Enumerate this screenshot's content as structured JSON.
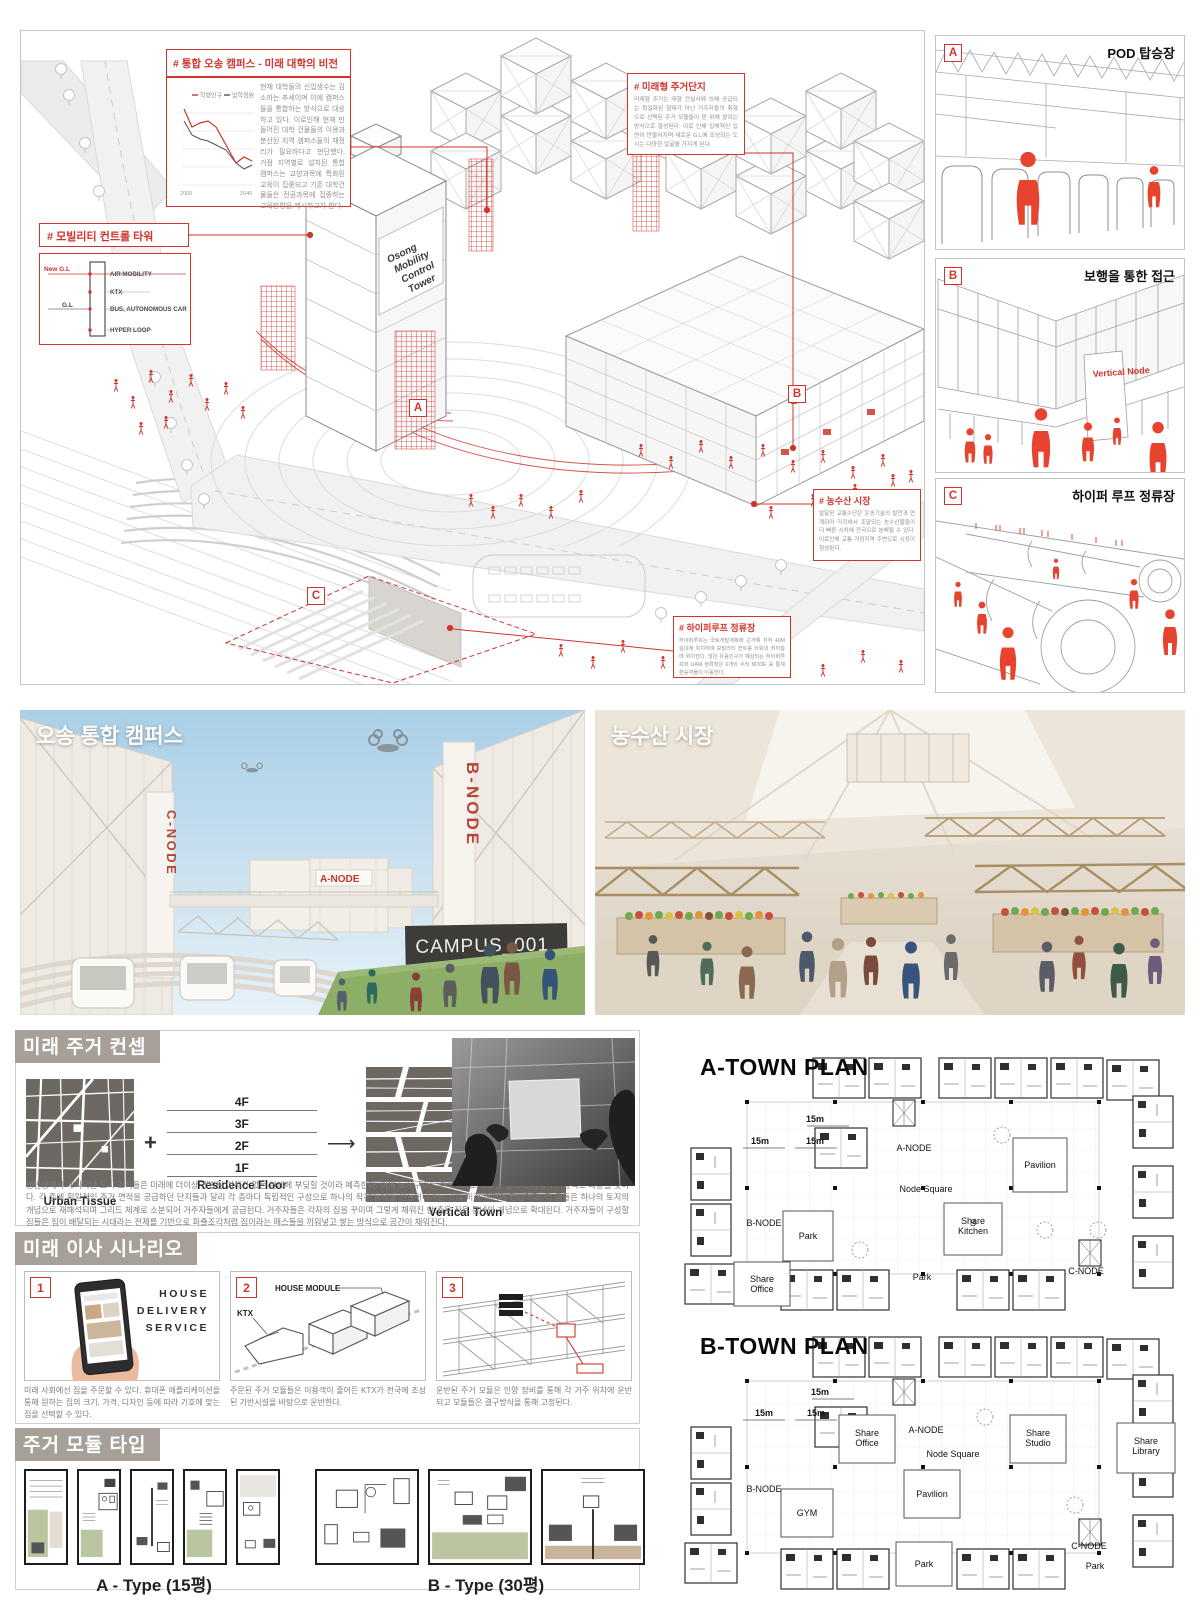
{
  "iso": {
    "tower_label_lines": [
      "Osong",
      "Mobility",
      "Control",
      "Tower"
    ],
    "markers": {
      "a": "A",
      "b": "B",
      "c": "C"
    },
    "callout_campus": {
      "title": "# 통합 오송 캠퍼스 - 미래 대학의 비전",
      "body": "현재 대학들의 신입생수는 감소하는 추세이며 이에 캠퍼스들을 통합하는 방식으로 대응하고 있다. 이로인해 현재 만들어진 대학 건물들의 이용과 분산된 지역 캠퍼스들의 재정리가 필요하다고 판단했다. 거점 지역별로 설치된 통합 캠퍼스는 교양과목에 특화된 교육이 집중되고 기존 대학건물들은 전공과목에 집중하는 교육방향을 제시하고자 한다.",
      "chart": {
        "type": "line",
        "legend": [
          "학령인구",
          "입학정원"
        ],
        "x_ticks": [
          "2000",
          "2040"
        ],
        "series": [
          {
            "name": "학령인구",
            "color": "#d0342c",
            "values": [
              88,
              70,
              74,
              76,
              66,
              48,
              40,
              44,
              41
            ]
          },
          {
            "name": "입학정원",
            "color": "#555555",
            "values": [
              76,
              62,
              58,
              56,
              52,
              47,
              40,
              36,
              39
            ]
          }
        ]
      }
    },
    "callout_mobility": {
      "title": "# 모빌리티 컨트롤 타워",
      "gl_new": "New G.L",
      "gl": "G.L",
      "levels": [
        "AIR MOBILITY",
        "KTX",
        "BUS, AUTONOMOUS CAR",
        "HYPER LOOP"
      ]
    },
    "callout_housing": {
      "title": "# 미래형 주거단지",
      "body": "미래형 주거는 대형 건설사에 의해 공급되는 획일화된 형태가 아닌 거주자들의 취향으로 선택된 주거 모듈들이 판 위에 쌓이는 방식으로 형성된다. 이로 인해 입체적인 입면이 만들어지며 새로운 G.L에 조성되는 도시는 다양한 얼굴을 가지게 된다."
    },
    "callout_market": {
      "title": "# 농수산 시장",
      "body": "발달된 교통수단은 운송기술의 발전과 연계되어 각지에서 조달되는 농수산물들이 더 빠른 시차에 전국으로 분배될 수 있다. 이로인해 교통 거점지역 주변으로 시장이 형성된다."
    },
    "callout_hyperloop": {
      "title": "# 하이퍼루프 정류장",
      "body": "하이퍼루프는 국토개발계획에 근거해 지하 40M 깊이에 위치하며 모빌리티 컨트롤 타워의 최하층에 위치한다. 많은 유동인구가 예상되는 하이퍼루프와 UAM 정류장은 6개의 수직 NODE 를 통해 환승객들이 이동한다."
    }
  },
  "panels": [
    {
      "badge": "A",
      "title": "POD 탑승장"
    },
    {
      "badge": "B",
      "title": "보행을 통한 접근",
      "note": "Vertical Node"
    },
    {
      "badge": "C",
      "title": "하이퍼 루프 정류장"
    }
  ],
  "renders": {
    "campus": {
      "title": "오송 통합 캠퍼스",
      "sign_cnode": "C-NODE",
      "sign_anode": "A-NODE",
      "sign_bnode": "B-NODE",
      "banner": "CAMPUS_001"
    },
    "market": {
      "title": "농수산 시장"
    }
  },
  "concept": {
    "header": "미래 주거 컨셉",
    "urban_label": "Urban Tissue",
    "residence_label": "Residence Floor",
    "vertical_label": "Vertical Town",
    "floors": [
      "4F",
      "3F",
      "2F",
      "1F"
    ],
    "plus": "+",
    "arrow": "⟶",
    "body": "평면상에서 계획되던 도시 조직들은 미래에 더이상 개발될 여지가 없는 한계에 부딪힐 것이라 예측한다. 이에 도시구조는 수직적으로 확장될 것이며 이에 주거양식도 대응될 것이다. 각 층에 획일적인 주거 면적을 공급하던 단지들과 달리 각 층마다 독립적인 구성으로 하나의 작은 동네를 만들어나가는 것이 미래 주거의 컨셉이다. 각 층들은 하나의 토지의 개념으로 재해석되며 그리드 체계로 소분되어 거주자들에게 공급된다. 거주자들은 각자의 집을 꾸미며 그렇게 채워진 한 층은 작은 동네의 개념으로 확대된다. 거주자들이 구성할 집들은 집이 배달되는 시대라는 전제를 기반으로 퍼즐조각처럼 집이라는 매스들을 끼워넣고 쌓는 방식으로 공간이 채워진다."
  },
  "scenario": {
    "header": "미래 이사 시나리오",
    "items": [
      {
        "num": "1",
        "service": "HOUSE DELIVERY SERVICE",
        "caption": "미래 사회에선 집을 주문할 수 있다. 휴대폰 애플리케이션을 통해 원하는 집의 크기, 가격, 디자인 등에 따라 기호에 맞는 집을 선택할 수 있다."
      },
      {
        "num": "2",
        "label_module": "HOUSE MODULE",
        "label_ktx": "KTX",
        "caption": "주문된 주거 모듈들은 이용객이 줄어든 KTX가 전국에 조성된 기반시설을 바탕으로 운반한다."
      },
      {
        "num": "3",
        "caption": "운반된 주거 모듈은 인양 장비를 통해 각 거주 위치에 운반되고 모듈들은 결구방식을 통해 고정된다."
      }
    ]
  },
  "modules": {
    "header": "주거 모듈 타입",
    "a_label": "A - Type (15평)",
    "b_label": "B - Type (30평)"
  },
  "plans": {
    "a": {
      "title": "A-TOWN PLAN",
      "dim": "15m",
      "labels": {
        "anode": "A-NODE",
        "node_square": "Node Square",
        "pavilion": "Pavilion",
        "bnode": "B-NODE",
        "park1": "Park",
        "share_kitchen": "Share Kitchen",
        "share_office": "Share Office",
        "park2": "Park",
        "cnode": "C-NODE"
      }
    },
    "b": {
      "title": "B-TOWN PLAN",
      "dim": "15m",
      "labels": {
        "share_office": "Share Office",
        "anode": "A-NODE",
        "node_square": "Node Square",
        "share_studio": "Share Studio",
        "share_library": "Share Library",
        "bnode": "B-NODE",
        "gym": "GYM",
        "pavilion": "Pavilion",
        "park1": "Park",
        "cnode": "C-NODE",
        "park2": "Park"
      }
    }
  }
}
